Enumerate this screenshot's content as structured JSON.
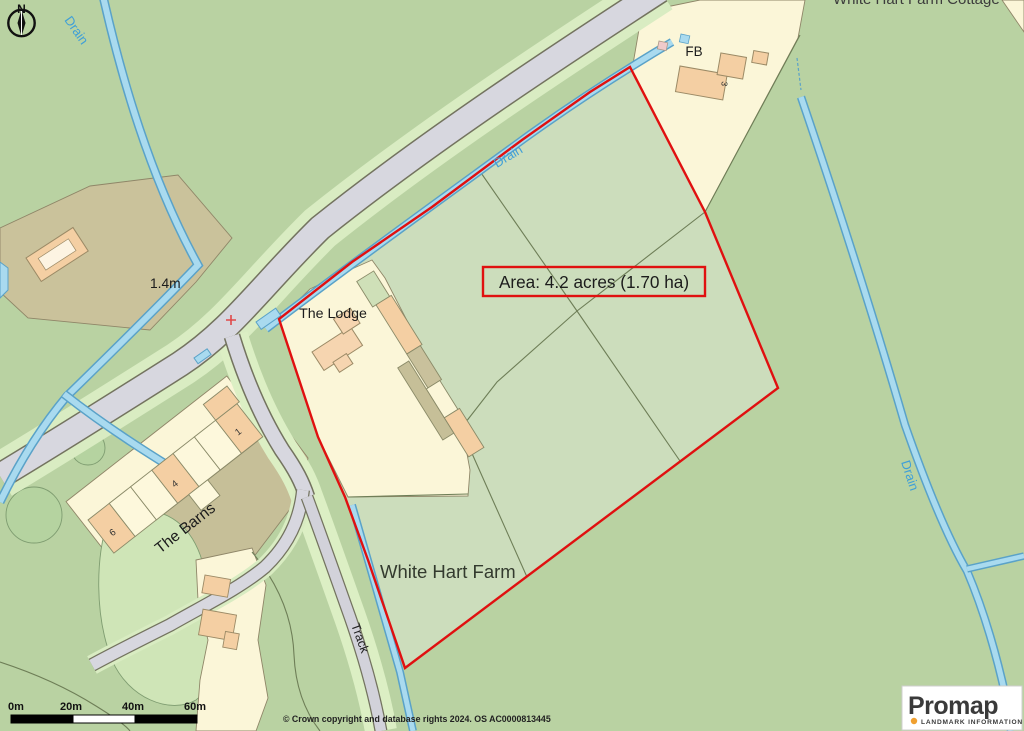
{
  "map": {
    "compass": {
      "label": "N"
    },
    "labels": {
      "top_cutoff": "White Hart Farm Cottage",
      "drains": [
        "Drain",
        "Drain",
        "Drain"
      ],
      "the_lodge": "The Lodge",
      "the_barns": "The Barns",
      "white_hart_farm": "White Hart Farm",
      "fb": "FB",
      "track": "Track",
      "depth_marker": "1.4m",
      "house_numbers": [
        "1",
        "4",
        "6"
      ],
      "fb_house_number": "3"
    },
    "area_box": {
      "text": "Area: 4.2 acres (1.70 ha)",
      "border_color": "#e01010"
    },
    "boundary_color": "#e01010",
    "scale_bar": {
      "labels": [
        "0m",
        "20m",
        "40m",
        "60m"
      ]
    },
    "attribution": "© Crown copyright and database rights 2024. OS AC0000813445",
    "logo": {
      "brand": "Promap",
      "tagline": "LANDMARK INFORMATION",
      "dot_color": "#f0a030"
    },
    "palette": {
      "base_green": "#b9d2a2",
      "plot_green": "#ccddbc",
      "cream": "#fbf6d8",
      "building_orange": "#f4cfa3",
      "khaki_field": "#cac29b",
      "farmyard": "#c6bf98",
      "road_gray": "#d7d7df",
      "verge_green": "#d9ecc2",
      "drain_fill": "#a9daef",
      "drain_edge": "#5aa2c8",
      "drain_text": "#3f9fd8",
      "paddock_green": "#cfe5b7"
    }
  }
}
